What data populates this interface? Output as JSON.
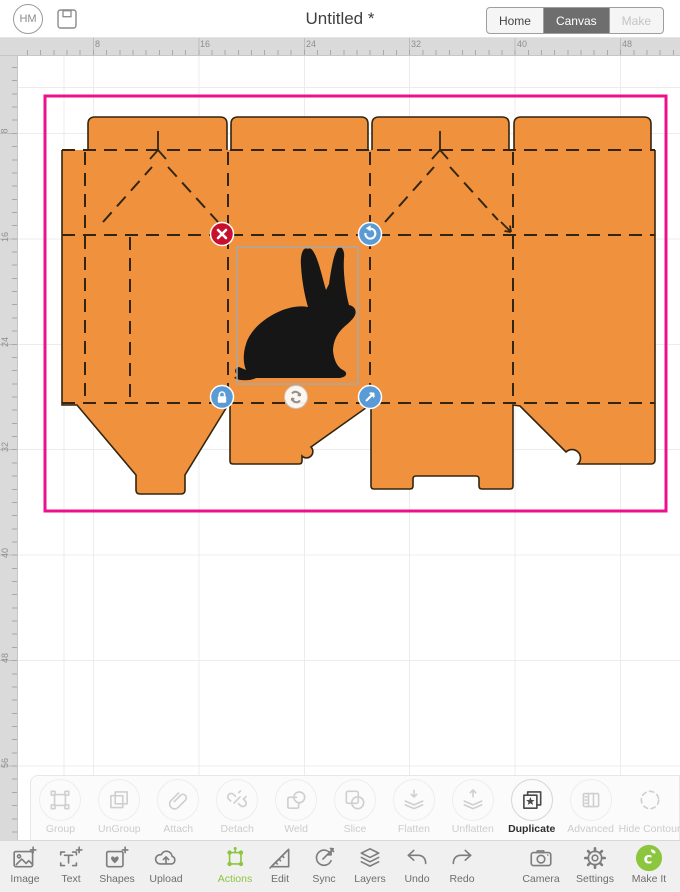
{
  "header": {
    "avatar_initials": "HM",
    "title": "Untitled *",
    "nav": {
      "home": "Home",
      "canvas": "Canvas",
      "make": "Make"
    }
  },
  "rulers": {
    "horizontal": [
      "8",
      "16",
      "24",
      "32",
      "40",
      "48"
    ],
    "vertical": [
      "8",
      "16",
      "24",
      "32",
      "40",
      "48",
      "56"
    ]
  },
  "canvas": {
    "selection_pink": "#EC108C",
    "template_fill": "#F0923D",
    "template_outline": "#33250F",
    "rabbit_fill": "#161616",
    "selection_box_stroke": "#A8A8A8",
    "handle_blue": "#5B9BD5",
    "handle_red": "#C8102E",
    "handle_move_fill": "#FFFFFF",
    "handle_move_glyph": "#8F8F8F",
    "handles": [
      "delete",
      "rotate",
      "lock",
      "resize",
      "move"
    ]
  },
  "actions_row": {
    "items": [
      {
        "label": "Group",
        "enabled": false
      },
      {
        "label": "UnGroup",
        "enabled": false
      },
      {
        "label": "Attach",
        "enabled": false
      },
      {
        "label": "Detach",
        "enabled": false
      },
      {
        "label": "Weld",
        "enabled": false
      },
      {
        "label": "Slice",
        "enabled": false
      },
      {
        "label": "Flatten",
        "enabled": false
      },
      {
        "label": "Unflatten",
        "enabled": false
      },
      {
        "label": "Duplicate",
        "enabled": true
      },
      {
        "label": "Advanced",
        "enabled": false
      },
      {
        "label": "Hide Contour",
        "enabled": false
      }
    ]
  },
  "bottom_bar": {
    "accent_green": "#8CC63F",
    "items": [
      {
        "label": "Image",
        "active": false
      },
      {
        "label": "Text",
        "active": false
      },
      {
        "label": "Shapes",
        "active": false
      },
      {
        "label": "Upload",
        "active": false
      },
      {
        "label": "Actions",
        "active": true
      },
      {
        "label": "Edit",
        "active": false
      },
      {
        "label": "Sync",
        "active": false
      },
      {
        "label": "Layers",
        "active": false
      },
      {
        "label": "Undo",
        "active": false
      },
      {
        "label": "Redo",
        "active": false
      },
      {
        "label": "Camera",
        "active": false
      },
      {
        "label": "Settings",
        "active": false
      },
      {
        "label": "Make It",
        "active": false
      }
    ]
  }
}
